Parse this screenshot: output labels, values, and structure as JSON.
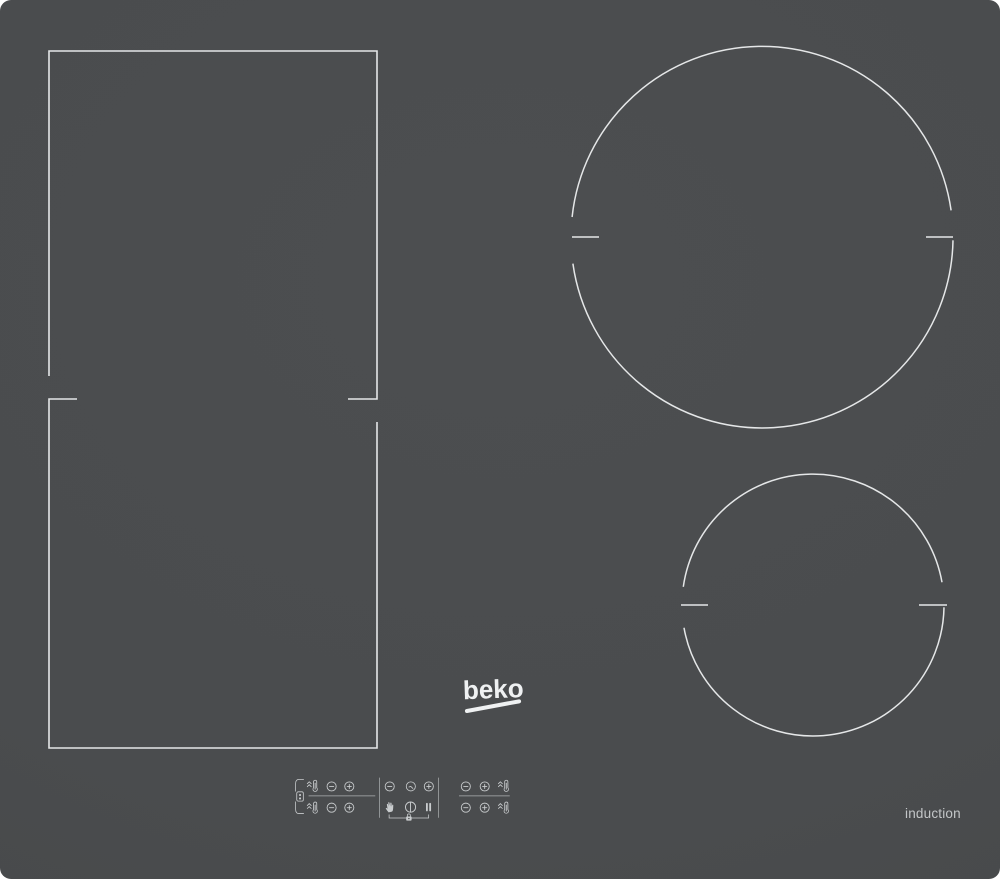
{
  "brand": {
    "logo_text": "beko"
  },
  "labels": {
    "type": "induction"
  },
  "surface": {
    "color": "#4a4c4e",
    "zone_line_color": "#e5e7e8",
    "icon_color": "#c9ccce",
    "divider_color": "#aeb1b3"
  },
  "zones": [
    {
      "id": "flex-zone-top",
      "shape": "rectangle",
      "role": "upper half of left flex cooking zone"
    },
    {
      "id": "flex-zone-bottom",
      "shape": "rectangle",
      "role": "lower half of left flex cooking zone"
    },
    {
      "id": "zone-large-round",
      "shape": "circle",
      "role": "large cooking zone, top right"
    },
    {
      "id": "zone-small-round",
      "shape": "circle",
      "role": "small cooking zone, bottom right"
    }
  ],
  "controls": {
    "flex_group": {
      "link_icon": "flex-link-icon",
      "bracket": "flex-bracket",
      "rows": [
        {
          "icons": [
            "booster-icon",
            "minus-icon",
            "plus-icon"
          ]
        },
        {
          "icons": [
            "booster-icon",
            "minus-icon",
            "plus-icon"
          ]
        }
      ]
    },
    "center_group": {
      "top_row": [
        "minus-icon",
        "timer-clock-icon",
        "plus-icon"
      ],
      "bottom_row": [
        "pause-hand-icon",
        "power-icon",
        "pause-icon"
      ],
      "lock_icon": "key-lock-icon"
    },
    "right_group": {
      "rows": [
        {
          "icons": [
            "minus-icon",
            "plus-icon",
            "booster-icon"
          ]
        },
        {
          "icons": [
            "minus-icon",
            "plus-icon",
            "booster-icon"
          ]
        }
      ]
    }
  }
}
